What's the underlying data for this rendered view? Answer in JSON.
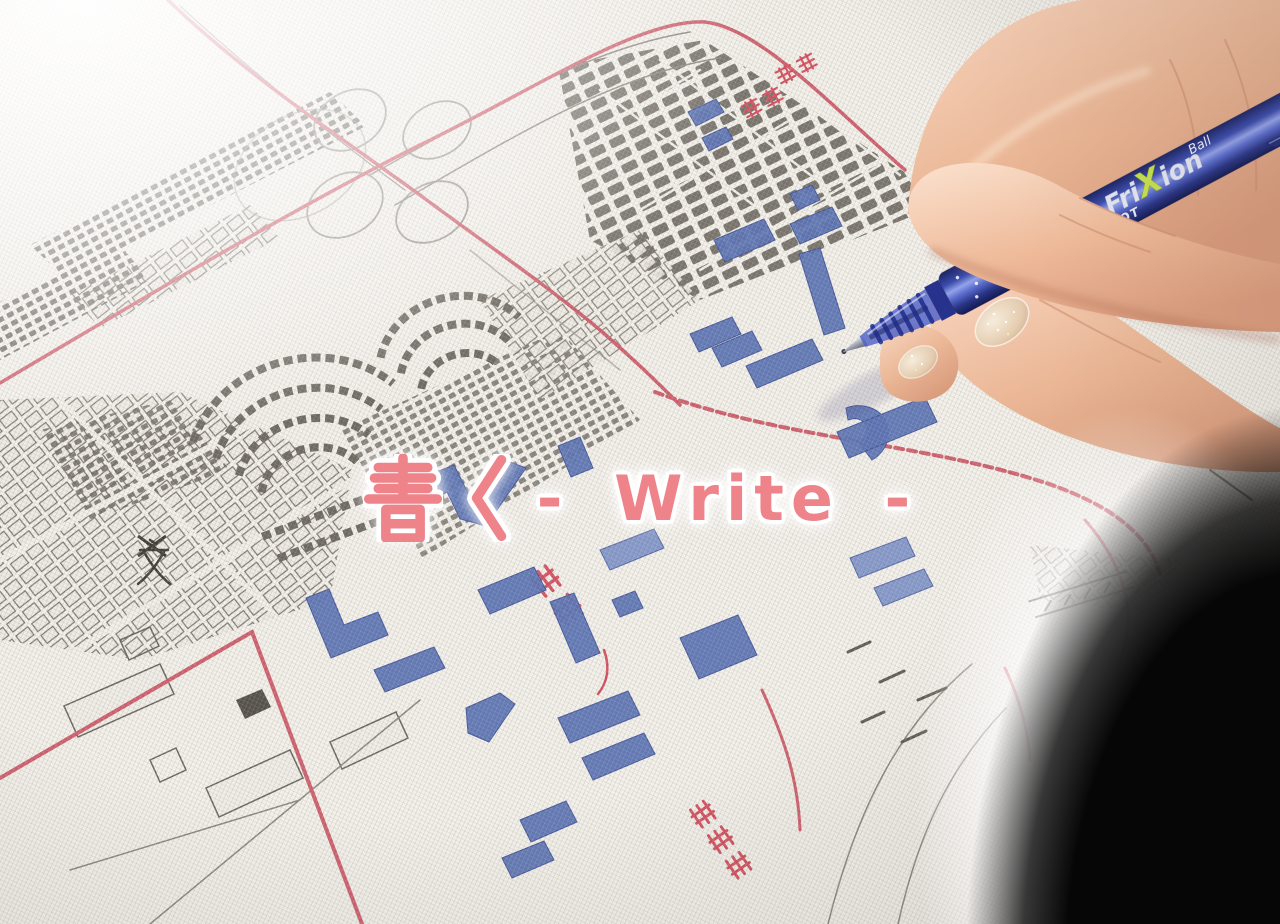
{
  "overlay": {
    "full_text": "書く - Write -",
    "kanji": "書く",
    "latin": "- Write -"
  },
  "pen": {
    "brand": "PILOT",
    "model": "FriXion",
    "model_fri": "Fri",
    "model_x": "X",
    "model_ion": "ion",
    "variant": "Ball"
  },
  "map": {
    "labels": {
      "yokohama": "横浜",
      "station_top_1": "東神",
      "station_top_2": "奈川",
      "station_bottom": "東高島",
      "school_symbol": "文"
    }
  },
  "colors": {
    "overlay_pink": "#ee838a",
    "pen_blue": "#3b49ae",
    "pen_blue_dark": "#232f7d",
    "ink_blue": "#5b73b4",
    "road_red": "#cf5f6d",
    "label_red": "#d4505f",
    "block_gray": "#6e6961",
    "fabric_white": "#f3f0ea",
    "skin": "#eec0a6",
    "nail_glitter": "#e9d6c0",
    "shadow_black": "#060606",
    "frixion_x_lime": "#c6e04e"
  }
}
